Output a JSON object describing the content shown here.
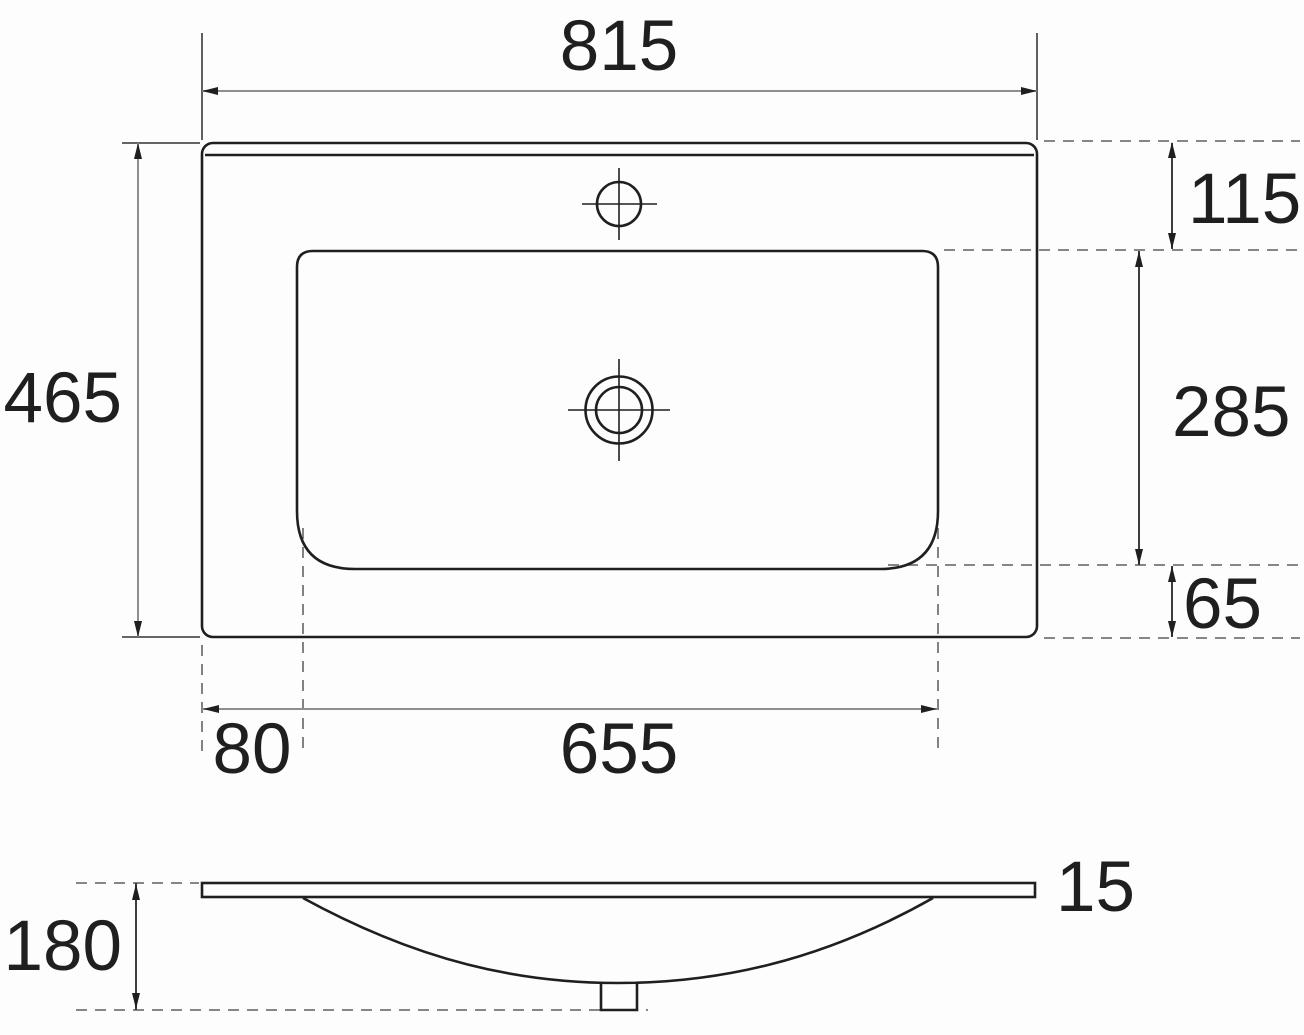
{
  "drawing": {
    "views": {
      "top_view": "washbasin-top-view",
      "side_view": "washbasin-side-profile"
    },
    "dimensions": {
      "top": {
        "overall_width": "815",
        "overall_depth": "465",
        "back_edge_to_basin": "115",
        "basin_depth": "285",
        "basin_to_front_edge": "65",
        "left_edge_to_basin": "80",
        "basin_width": "655"
      },
      "side": {
        "overall_height": "180",
        "rim_thickness": "15"
      }
    },
    "colors": {
      "background": "#fdfdfd",
      "outline": "#1f1f1f",
      "dim_gray": "#8e8e8e",
      "dim_dark": "#3d3d3d",
      "extension": "#4f4f4f",
      "dash": "#757575",
      "arrow": "#1f1f1f",
      "text": "#1f1f1f"
    }
  }
}
